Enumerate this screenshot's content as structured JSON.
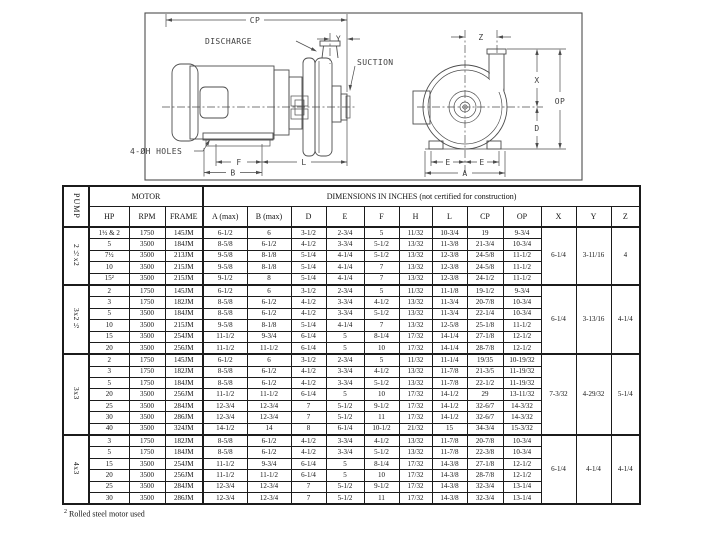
{
  "drawing": {
    "labels": {
      "cp": "CP",
      "y_dim": "Y",
      "z_dim": "Z",
      "x_dim": "X",
      "op": "OP",
      "d_dim": "D",
      "e_left": "E",
      "e_right": "E",
      "a_dim": "A",
      "f_dim": "F",
      "b_dim": "B",
      "l_dim": "L",
      "discharge": "DISCHARGE",
      "suction": "SUCTION",
      "holes": "4-ØH HOLES"
    }
  },
  "table": {
    "pump_header": "PUMP",
    "motor_header": "MOTOR",
    "dimensions_header": "DIMENSIONS IN INCHES (not certified for construction)",
    "columns": [
      "HP",
      "RPM",
      "FRAME",
      "A (max)",
      "B (max)",
      "D",
      "E",
      "F",
      "H",
      "L",
      "CP",
      "OP",
      "X",
      "Y",
      "Z"
    ],
    "groups": [
      {
        "pump": "2½x2",
        "x": "6-1/4",
        "y": "3-11/16",
        "z": "4",
        "rows": [
          [
            "1½ & 2",
            "1750",
            "145JM",
            "6-1/2",
            "6",
            "3-1/2",
            "2-3/4",
            "5",
            "11/32",
            "10-3/4",
            "19",
            "9-3/4"
          ],
          [
            "5",
            "3500",
            "184JM",
            "8-5/8",
            "6-1/2",
            "4-1/2",
            "3-3/4",
            "5-1/2",
            "13/32",
            "11-3/8",
            "21-3/4",
            "10-3/4"
          ],
          [
            "7½",
            "3500",
            "213JM",
            "9-5/8",
            "8-1/8",
            "5-1/4",
            "4-1/4",
            "5-1/2",
            "13/32",
            "12-3/8",
            "24-5/8",
            "11-1/2"
          ],
          [
            "10",
            "3500",
            "215JM",
            "9-5/8",
            "8-1/8",
            "5-1/4",
            "4-1/4",
            "7",
            "13/32",
            "12-3/8",
            "24-5/8",
            "11-1/2"
          ],
          [
            "15²",
            "3500",
            "215JM",
            "9-1/2",
            "8",
            "5-1/4",
            "4-1/4",
            "7",
            "13/32",
            "12-3/8",
            "24-1/2",
            "11-1/2"
          ]
        ]
      },
      {
        "pump": "3x2½",
        "x": "6-1/4",
        "y": "3-13/16",
        "z": "4-1/4",
        "rows": [
          [
            "2",
            "1750",
            "145JM",
            "6-1/2",
            "6",
            "3-1/2",
            "2-3/4",
            "5",
            "11/32",
            "11-1/8",
            "19-1/2",
            "9-3/4"
          ],
          [
            "3",
            "1750",
            "182JM",
            "8-5/8",
            "6-1/2",
            "4-1/2",
            "3-3/4",
            "4-1/2",
            "13/32",
            "11-3/4",
            "20-7/8",
            "10-3/4"
          ],
          [
            "5",
            "3500",
            "184JM",
            "8-5/8",
            "6-1/2",
            "4-1/2",
            "3-3/4",
            "5-1/2",
            "13/32",
            "11-3/4",
            "22-1/4",
            "10-3/4"
          ],
          [
            "10",
            "3500",
            "215JM",
            "9-5/8",
            "8-1/8",
            "5-1/4",
            "4-1/4",
            "7",
            "13/32",
            "12-5/8",
            "25-1/8",
            "11-1/2"
          ],
          [
            "15",
            "3500",
            "254JM",
            "11-1/2",
            "9-3/4",
            "6-1/4",
            "5",
            "8-1/4",
            "17/32",
            "14-1/4",
            "27-1/8",
            "12-1/2"
          ],
          [
            "20",
            "3500",
            "256JM",
            "11-1/2",
            "11-1/2",
            "6-1/4",
            "5",
            "10",
            "17/32",
            "14-1/4",
            "28-7/8",
            "12-1/2"
          ]
        ]
      },
      {
        "pump": "3x3",
        "x": "7-3/32",
        "y": "4-29/32",
        "z": "5-1/4",
        "rows": [
          [
            "2",
            "1750",
            "145JM",
            "6-1/2",
            "6",
            "3-1/2",
            "2-3/4",
            "5",
            "11/32",
            "11-1/4",
            "19/35",
            "10-19/32"
          ],
          [
            "3",
            "1750",
            "182JM",
            "8-5/8",
            "6-1/2",
            "4-1/2",
            "3-3/4",
            "4-1/2",
            "13/32",
            "11-7/8",
            "21-3/5",
            "11-19/32"
          ],
          [
            "5",
            "1750",
            "184JM",
            "8-5/8",
            "6-1/2",
            "4-1/2",
            "3-3/4",
            "5-1/2",
            "13/32",
            "11-7/8",
            "22-1/2",
            "11-19/32"
          ],
          [
            "20",
            "3500",
            "256JM",
            "11-1/2",
            "11-1/2",
            "6-1/4",
            "5",
            "10",
            "17/32",
            "14-1/2",
            "29",
            "13-11/32"
          ],
          [
            "25",
            "3500",
            "284JM",
            "12-3/4",
            "12-3/4",
            "7",
            "5-1/2",
            "9-1/2",
            "17/32",
            "14-1/2",
            "32-6/7",
            "14-3/32"
          ],
          [
            "30",
            "3500",
            "286JM",
            "12-3/4",
            "12-3/4",
            "7",
            "5-1/2",
            "11",
            "17/32",
            "14-1/2",
            "32-6/7",
            "14-3/32"
          ],
          [
            "40",
            "3500",
            "324JM",
            "14-1/2",
            "14",
            "8",
            "6-1/4",
            "10-1/2",
            "21/32",
            "15",
            "34-3/4",
            "15-3/32"
          ]
        ]
      },
      {
        "pump": "4x3",
        "x": "6-1/4",
        "y": "4-1/4",
        "z": "4-1/4",
        "rows": [
          [
            "3",
            "1750",
            "182JM",
            "8-5/8",
            "6-1/2",
            "4-1/2",
            "3-3/4",
            "4-1/2",
            "13/32",
            "11-7/8",
            "20-7/8",
            "10-3/4"
          ],
          [
            "5",
            "1750",
            "184JM",
            "8-5/8",
            "6-1/2",
            "4-1/2",
            "3-3/4",
            "5-1/2",
            "13/32",
            "11-7/8",
            "22-3/8",
            "10-3/4"
          ],
          [
            "15",
            "3500",
            "254JM",
            "11-1/2",
            "9-3/4",
            "6-1/4",
            "5",
            "8-1/4",
            "17/32",
            "14-3/8",
            "27-1/8",
            "12-1/2"
          ],
          [
            "20",
            "3500",
            "256JM",
            "11-1/2",
            "11-1/2",
            "6-1/4",
            "5",
            "10",
            "17/32",
            "14-3/8",
            "28-7/8",
            "12-1/2"
          ],
          [
            "25",
            "3500",
            "284JM",
            "12-3/4",
            "12-3/4",
            "7",
            "5-1/2",
            "9-1/2",
            "17/32",
            "14-3/8",
            "32-3/4",
            "13-1/4"
          ],
          [
            "30",
            "3500",
            "286JM",
            "12-3/4",
            "12-3/4",
            "7",
            "5-1/2",
            "11",
            "17/32",
            "14-3/8",
            "32-3/4",
            "13-1/4"
          ]
        ]
      }
    ],
    "footnote_marker": "2",
    "footnote_text": "Rolled steel motor used"
  }
}
